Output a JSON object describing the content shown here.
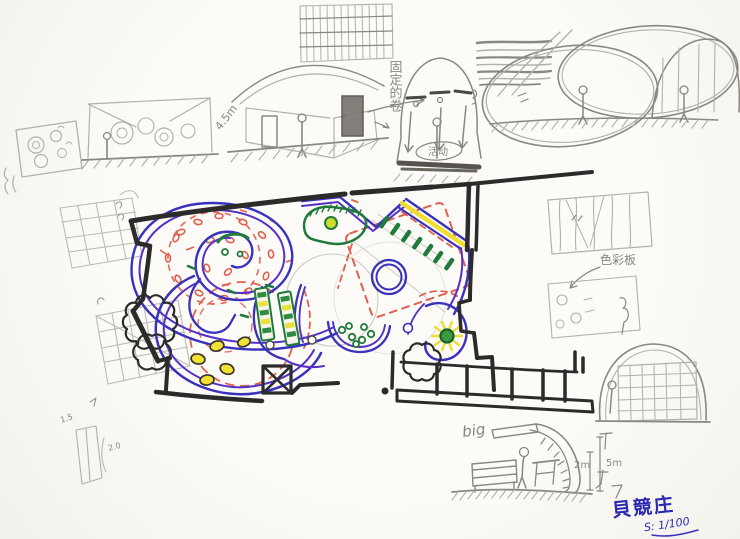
{
  "artwork": {
    "kind": "hand-drawn floor plan sketch with elevation studies",
    "colors": {
      "paper": "#fbfaf6",
      "marker_black": "#2b2b29",
      "ink_blue": "#3932bc",
      "ink_purple": "#5531c6",
      "accent_red": "#e0604e",
      "accent_green": "#1f7a3c",
      "accent_yellow": "#f2e033",
      "pencil_gray": "#a9a69f"
    }
  },
  "annotations": {
    "arch_height": "4.5m",
    "door_height": "3m",
    "vertical_note": "固定的卷",
    "activity_note": "活动",
    "material_note": "色彩板",
    "big_note": "big",
    "section_dim_small": "2m",
    "section_dim_large": "5m",
    "study_dim_a": "1.5",
    "study_dim_b": "2.0",
    "signature": "貝競庄",
    "scale_note": "S: 1/100"
  }
}
